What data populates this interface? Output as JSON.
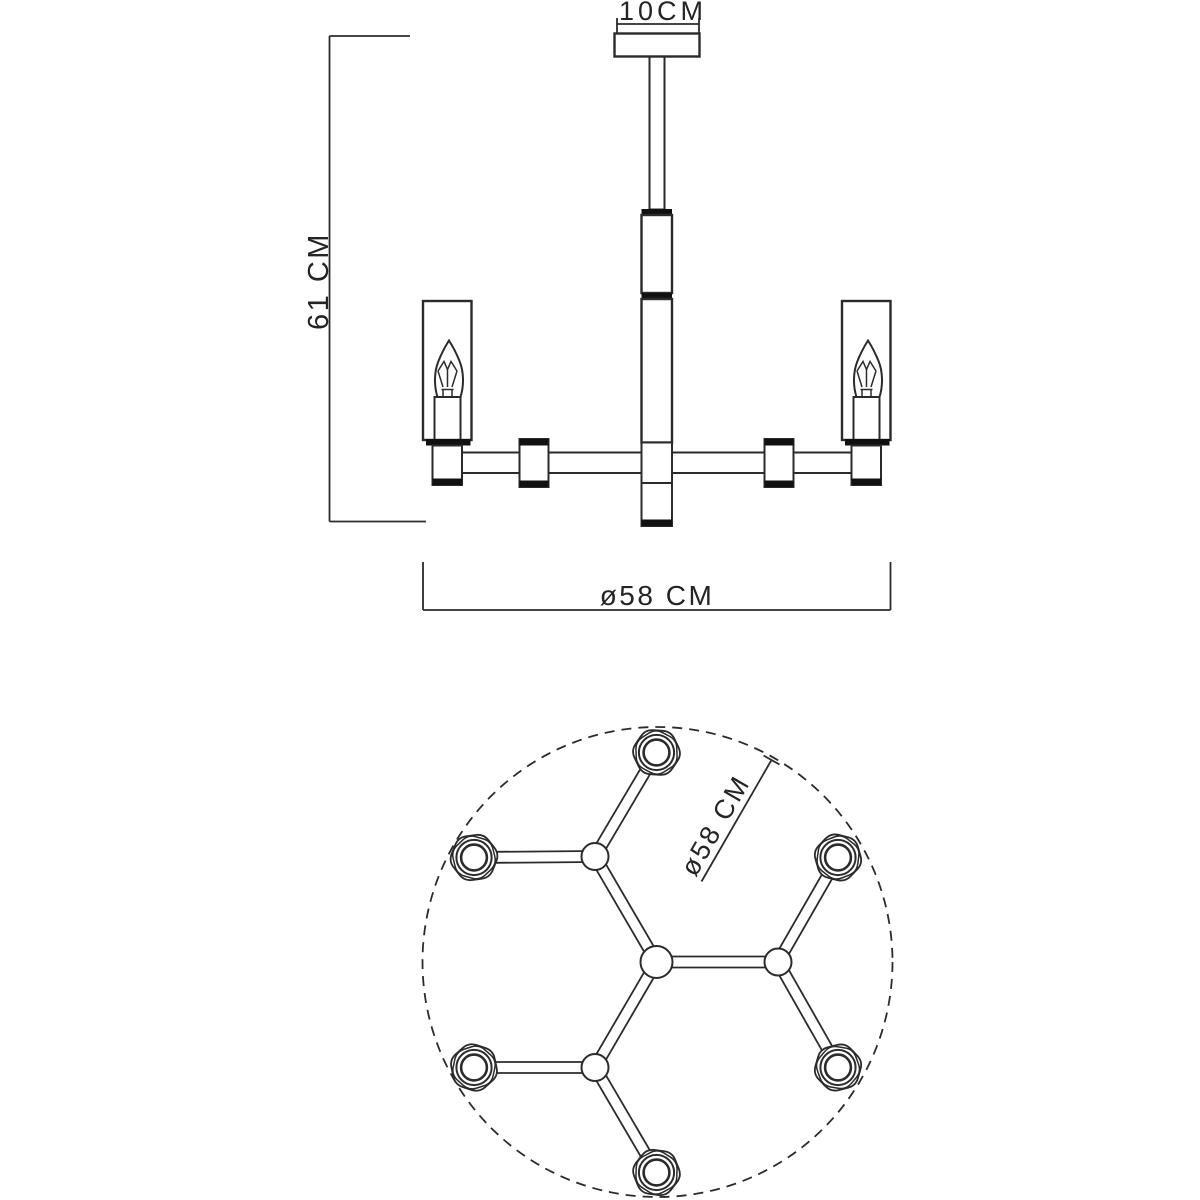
{
  "page": {
    "background": "#ffffff",
    "line_color": "#2b2b2b",
    "black_fill": "#111111",
    "title": "Chandelier technical drawing, side elevation and plan view"
  },
  "diagram": {
    "type": "technical-drawing",
    "product": "6-light candle chandelier",
    "side": {
      "canopy_label": "10CM",
      "height_label": "61 CM",
      "diameter_label": "ø58 CM",
      "lights_visible": 2
    },
    "plan": {
      "diameter_label": "ø58 CM",
      "sockets_count": 6
    },
    "specs": {
      "canopy_diameter_cm": 10,
      "height_cm": 61,
      "diameter_cm": 58,
      "lights": 6
    }
  },
  "plan_geometry": {
    "link_half_gap": 5.5,
    "link_stroke_width": 1.8,
    "circle": {
      "cx": 657.5,
      "cy": 962,
      "r": 235,
      "dash": "10 7"
    },
    "nodes": {
      "hub": {
        "x": 656.5,
        "y": 962,
        "r": 16,
        "kind": "hub"
      },
      "j0": {
        "x": 778,
        "y": 962,
        "r": 13.5,
        "kind": "joint"
      },
      "j120": {
        "x": 595,
        "y": 856.5,
        "r": 13.5,
        "kind": "joint"
      },
      "j240": {
        "x": 595,
        "y": 1067.5,
        "r": 13.5,
        "kind": "joint"
      },
      "s30": {
        "x": 838,
        "y": 857.5,
        "rot": 14,
        "kind": "socket"
      },
      "s90": {
        "x": 656.5,
        "y": 752.5,
        "rot": 4,
        "kind": "socket"
      },
      "s150": {
        "x": 474,
        "y": 857.5,
        "rot": -8,
        "kind": "socket"
      },
      "s210": {
        "x": 474,
        "y": 1067.5,
        "rot": 18,
        "kind": "socket"
      },
      "s270": {
        "x": 656.5,
        "y": 1172.5,
        "rot": 8,
        "kind": "socket"
      },
      "s330": {
        "x": 838,
        "y": 1067.5,
        "rot": -14,
        "kind": "socket"
      }
    },
    "links": [
      [
        "hub",
        "j0"
      ],
      [
        "hub",
        "j120"
      ],
      [
        "hub",
        "j240"
      ],
      [
        "j0",
        "s30"
      ],
      [
        "j0",
        "s330"
      ],
      [
        "j120",
        "s90"
      ],
      [
        "j120",
        "s150"
      ],
      [
        "j240",
        "s210"
      ],
      [
        "j240",
        "s270"
      ]
    ],
    "socket": {
      "hex_outer_r": 25.5,
      "hex_inner_r": 23.6,
      "ring_outer_r": 17.6,
      "ring_inner_r": 12.9
    }
  }
}
